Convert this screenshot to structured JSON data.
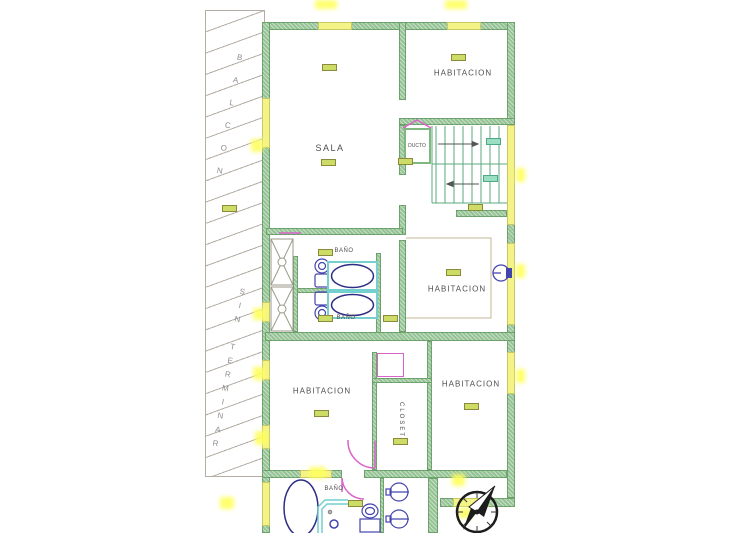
{
  "title": "Apartment floor plan",
  "balcony": {
    "label_upper": "BALCON",
    "label_lower": "SIN TERMINAR"
  },
  "rooms": {
    "sala": {
      "label": "SALA"
    },
    "habitacion_top_right": {
      "label": "HABITACION"
    },
    "habitacion_middle_right": {
      "label": "HABITACION"
    },
    "habitacion_bottom_left": {
      "label": "HABITACION"
    },
    "habitacion_bottom_right": {
      "label": "HABITACION"
    },
    "ducto": {
      "label": "DUCTO"
    },
    "closet": {
      "label": "CLOSET"
    },
    "bano_upper": {
      "label": "BAÑO"
    },
    "bano_lower": {
      "label": "BAÑO"
    },
    "bano_ground": {
      "label": "BAÑO"
    }
  },
  "colors": {
    "wall_green": "#95c395",
    "window_yellow": "#f3f388",
    "glow_yellow": "#ffff5e",
    "hatch_gray": "#b5aca4",
    "door_magenta": "#d964c9",
    "fixture_blue": "#4444ad",
    "fixture_navy": "#2d2d85",
    "fixture_cyan": "#74cfcf",
    "tag_green": "#ccdc66",
    "text_gray": "#4f4f4f"
  }
}
